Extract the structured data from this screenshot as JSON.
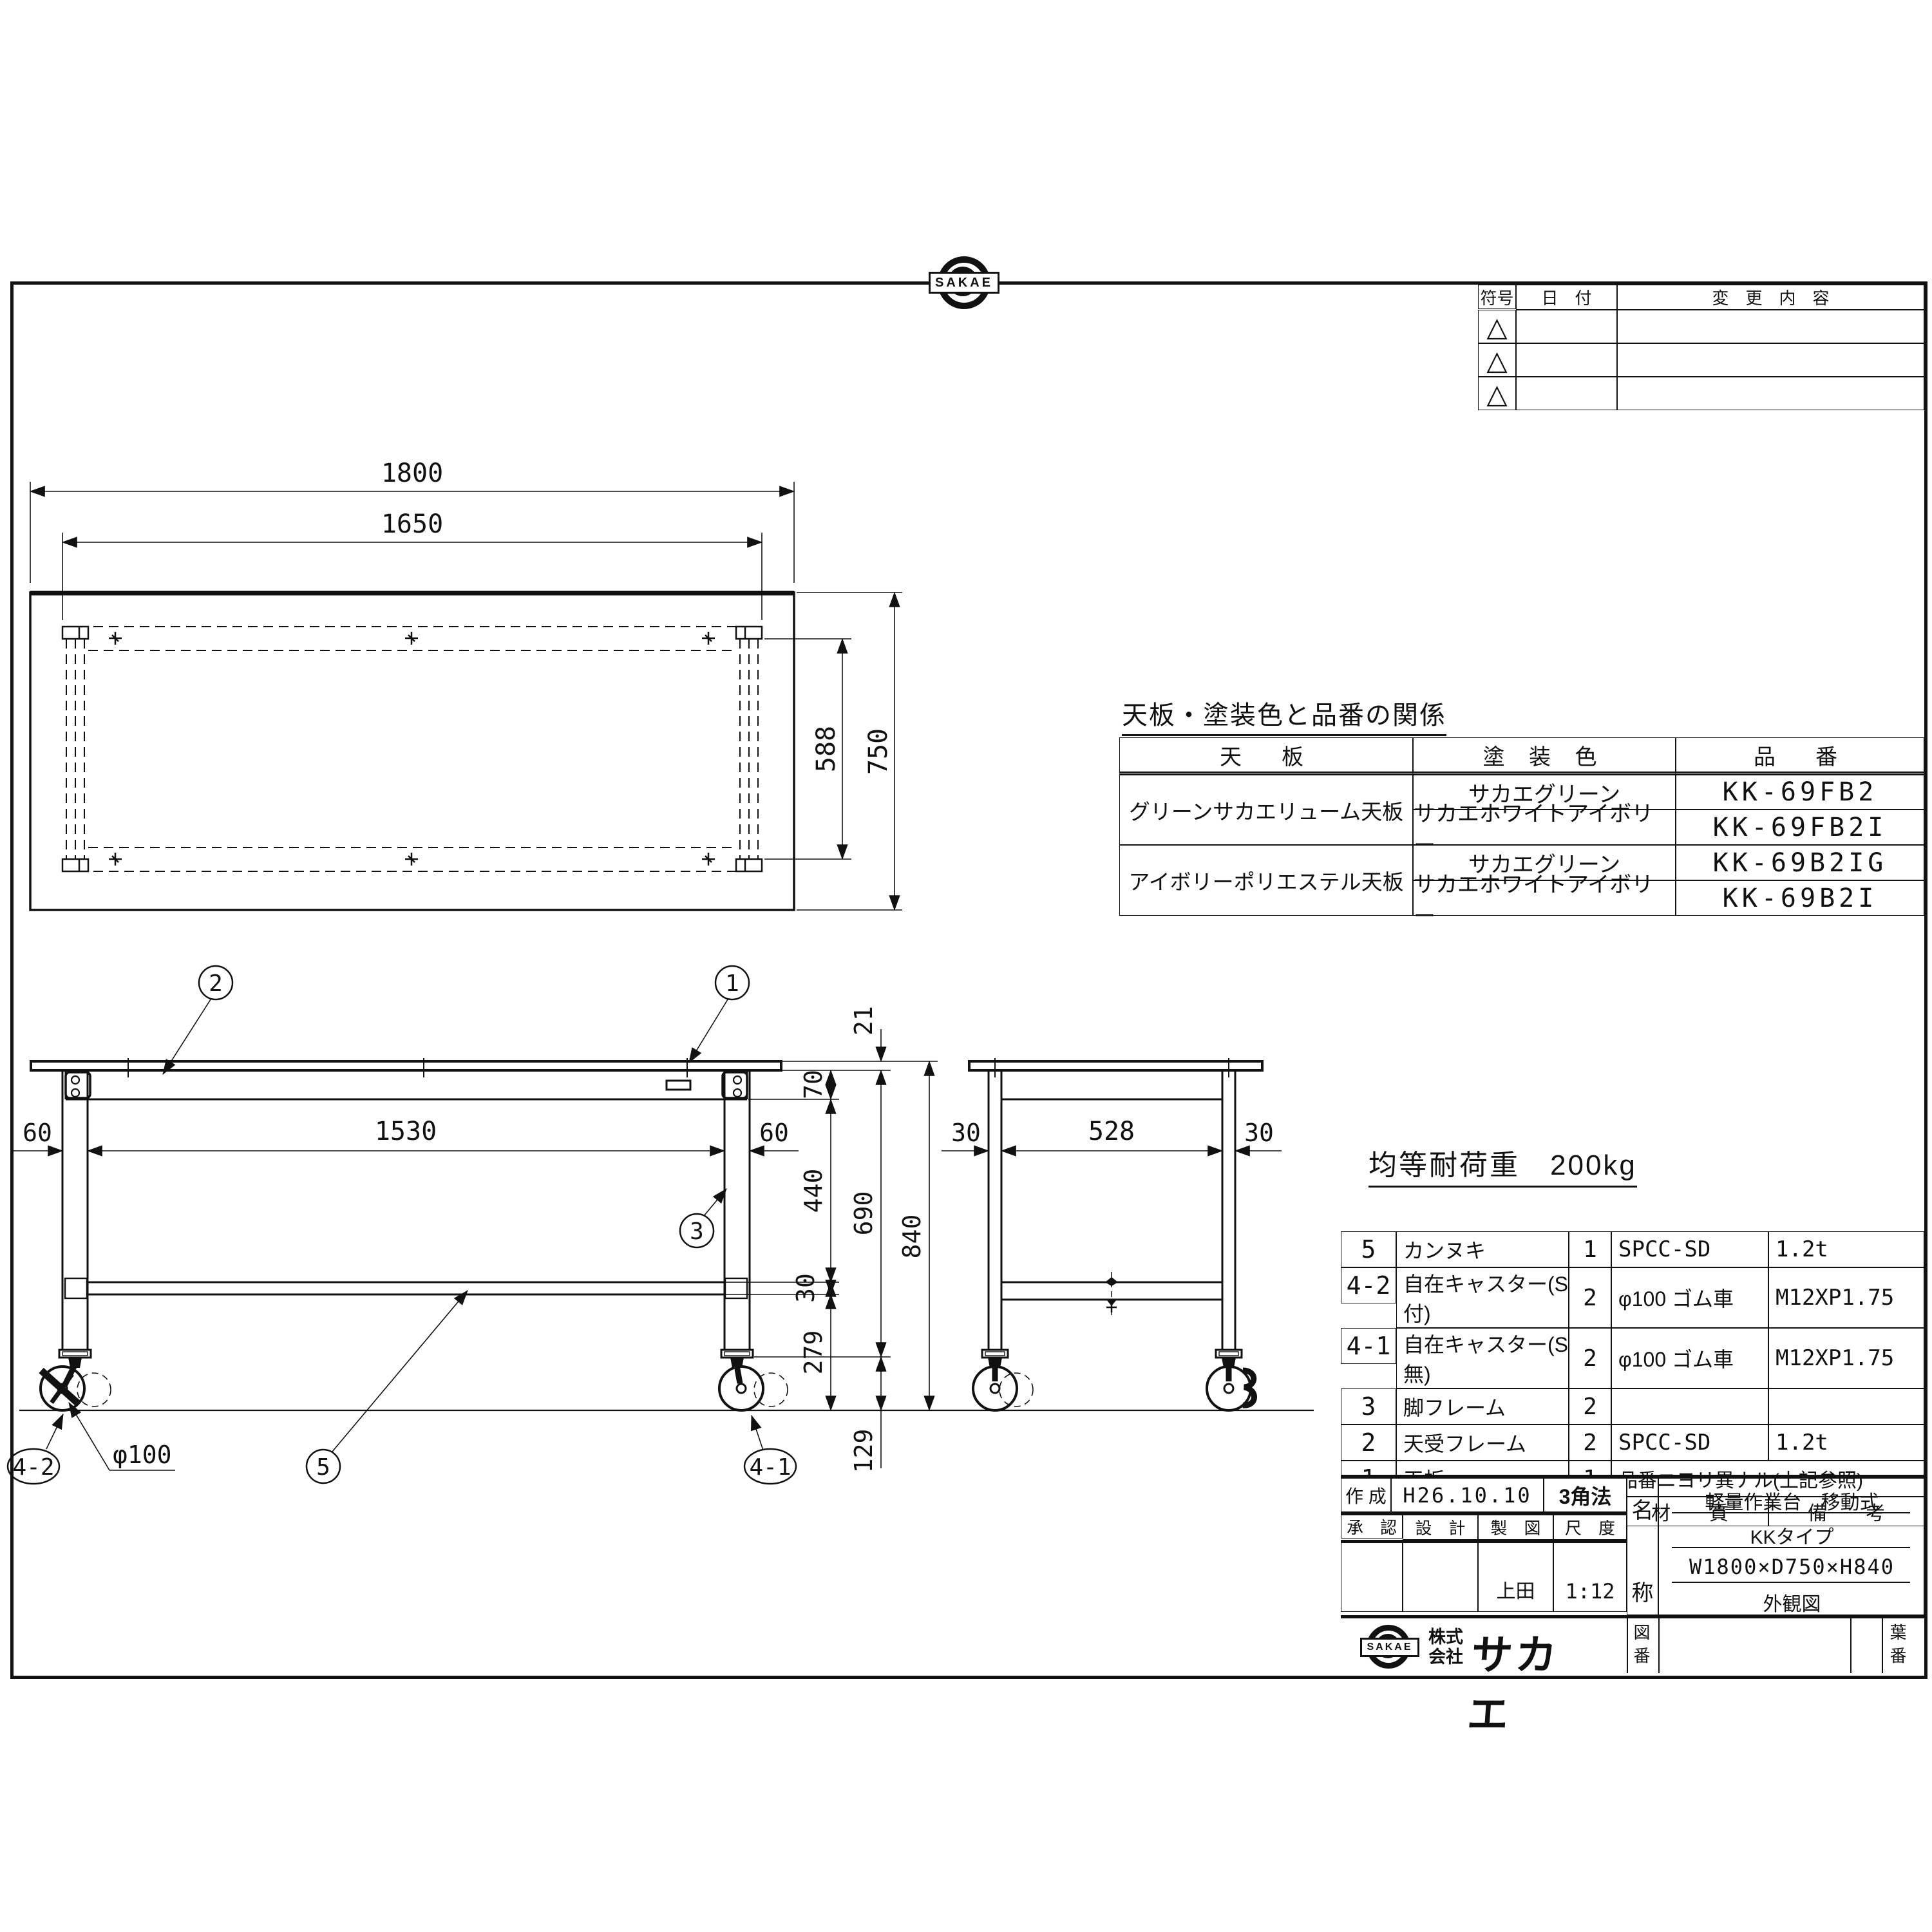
{
  "drawing": {
    "revision_table": {
      "col_symbol": "符号",
      "col_date": "日　付",
      "col_change": "変　更　内　容",
      "marker": "△"
    },
    "logo": {
      "brand": "SAKAE",
      "company_1": "株式",
      "company_2": "会社",
      "company_name": "サカエ"
    },
    "top_view": {
      "dim_width_outer": "1800",
      "dim_width_legs": "1650",
      "dim_depth_legs": "588",
      "dim_depth_outer": "750"
    },
    "front_view": {
      "dim_leg_left": "60",
      "dim_span": "1530",
      "dim_leg_right": "60",
      "dim_top_thickness": "21",
      "dim_apron": "70",
      "dim_apron_to_bar": "440",
      "dim_bar": "30",
      "dim_bar_to_floor": "279",
      "dim_caster": "129",
      "dim_under": "690",
      "dim_height": "840",
      "caster_dia": "φ100",
      "balloon_top": "1",
      "balloon_frame": "2",
      "balloon_leg": "3",
      "balloon_bar": "5",
      "balloon_caster_plain": "4-1",
      "balloon_caster_stop": "4-2"
    },
    "side_view": {
      "dim_leg_left": "30",
      "dim_span": "528",
      "dim_leg_right": "30"
    },
    "load_note": "均等耐荷重　200kg",
    "color_table": {
      "title": "天板・塗装色と品番の関係",
      "col_top": "天　板",
      "col_color": "塗 装 色",
      "col_code": "品　番",
      "rows": [
        {
          "top": "グリーンサカエリューム天板",
          "color": "サカエグリーン",
          "code": "KK-69FB2"
        },
        {
          "color": "サカエホワイトアイボリー",
          "code": "KK-69FB2I"
        },
        {
          "top": "アイボリーポリエステル天板",
          "color": "サカエグリーン",
          "code": "KK-69B2IG"
        },
        {
          "color": "サカエホワイトアイボリー",
          "code": "KK-69B2I"
        }
      ]
    },
    "parts_table": {
      "rows": [
        {
          "no": "5",
          "name": "カンヌキ",
          "qty": "1",
          "material": "SPCC-SD",
          "note": "1.2t"
        },
        {
          "no": "4-2",
          "name": "自在キャスター(S付)",
          "qty": "2",
          "material": "φ100 ゴム車",
          "note": "M12XP1.75"
        },
        {
          "no": "4-1",
          "name": "自在キャスター(S無)",
          "qty": "2",
          "material": "φ100 ゴム車",
          "note": "M12XP1.75"
        },
        {
          "no": "3",
          "name": "脚フレーム",
          "qty": "2",
          "material": "",
          "note": ""
        },
        {
          "no": "2",
          "name": "天受フレーム",
          "qty": "2",
          "material": "SPCC-SD",
          "note": "1.2t"
        },
        {
          "no": "1",
          "name": "天板",
          "qty": "1",
          "material": "品番ニヨリ異ナル(上記参照)",
          "note": ""
        }
      ],
      "header": {
        "no": "品 番",
        "name": "部　品　名",
        "qty1": "1台分",
        "qty2": "数 量",
        "material": "材　　質",
        "note": "備　　考"
      }
    },
    "title_block": {
      "created_label": "作 成",
      "created_value": "H26.10.10",
      "projection": "3角法",
      "approved_label": "承　認",
      "design_label": "設　計",
      "draft_label": "製　図",
      "scale_label": "尺　度",
      "draft_value": "上田",
      "scale_value": "1:12",
      "name_char_1": "名",
      "name_char_2": "称",
      "product_type": "軽量作業台　移動式",
      "product_series": "KKタイプ",
      "product_size": "W1800×D750×H840",
      "product_view": "外観図",
      "drawing_no_label": "図番",
      "sheet_no_label": "葉番"
    }
  }
}
